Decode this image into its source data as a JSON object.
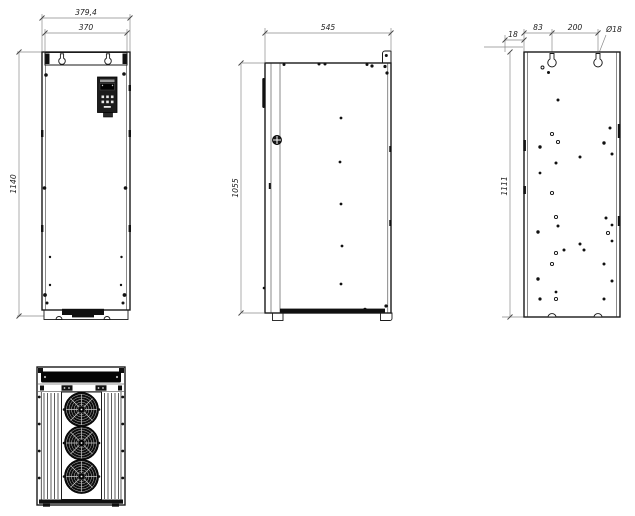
{
  "drawing": {
    "type": "engineering-orthographic-views",
    "colors": {
      "background": "#ffffff",
      "object_line": "#1a1a1a",
      "dimension_line": "#8a8a8a",
      "dark_fill": "#101010"
    },
    "front_view": {
      "dim_overall_width": "379,4",
      "dim_mounting_width": "370",
      "dim_height": "1140"
    },
    "side_view": {
      "dim_depth": "545",
      "dim_height": "1055"
    },
    "rear_view": {
      "dim_edge_offset": "18",
      "dim_hole_offset": "83",
      "dim_hole_spacing": "200",
      "dim_hole_diameter": "Ø18",
      "dim_height": "1111"
    }
  }
}
